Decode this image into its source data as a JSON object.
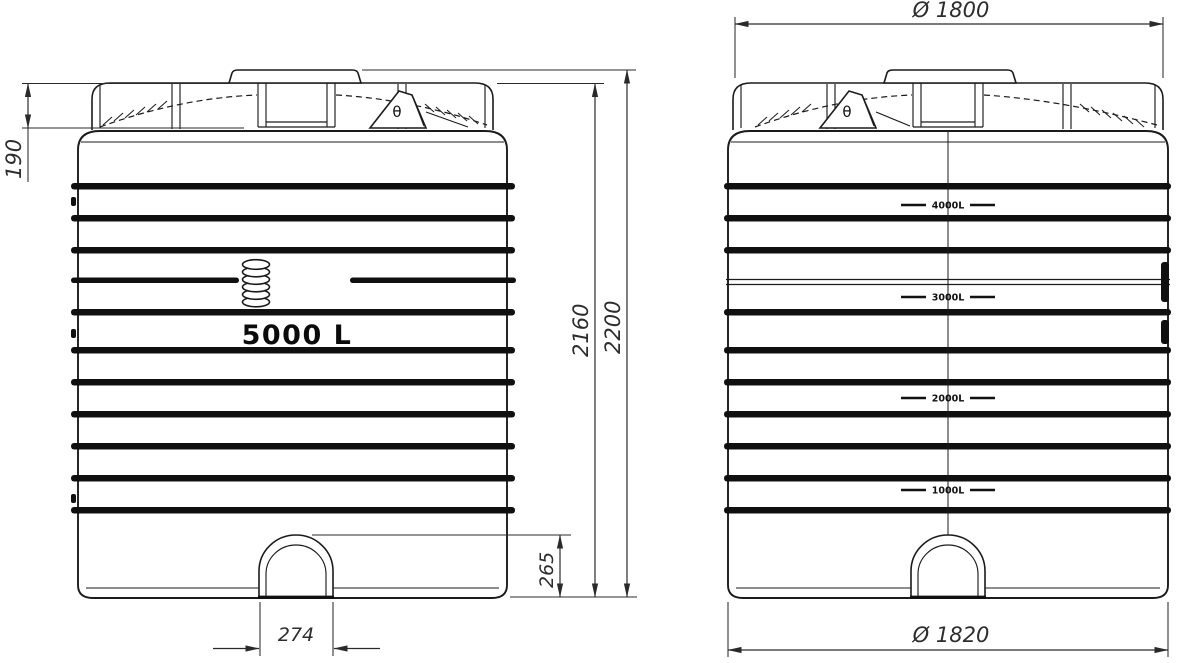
{
  "drawing": {
    "product_label": "5000 L",
    "vent_symbol": "θ",
    "dimensions": {
      "lid_height": "190",
      "body_height": "2160",
      "total_height": "2200",
      "outlet_recess_height": "265",
      "outlet_recess_width": "274",
      "top_diameter": "Ø 1800",
      "bottom_diameter": "Ø 1820"
    },
    "level_marks": [
      "4000L",
      "3000L",
      "2000L",
      "1000L"
    ],
    "colors": {
      "ink": "#1b1b1b",
      "background": "#ffffff"
    }
  }
}
